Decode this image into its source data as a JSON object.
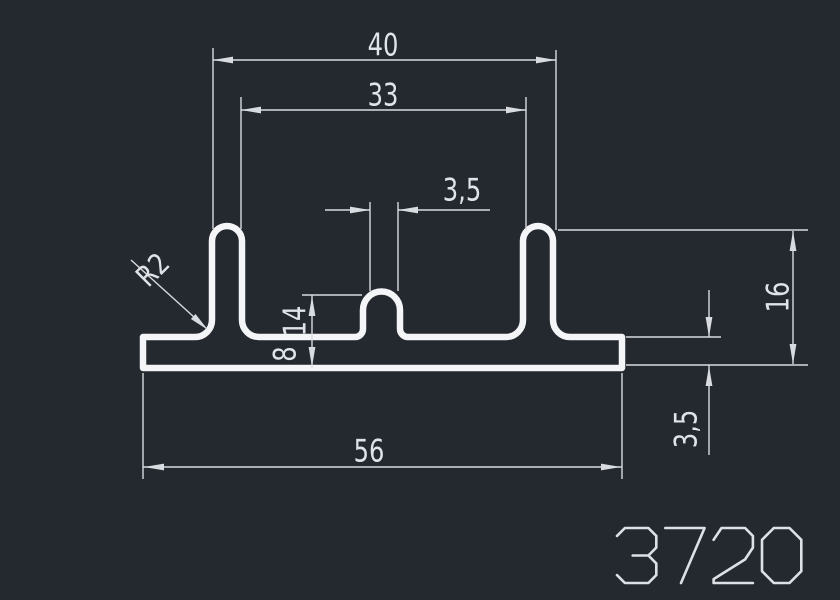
{
  "drawing": {
    "profile_number": "3720",
    "labels": {
      "width_fins_outer": "40",
      "width_fins_inner": "33",
      "bump_width": "3,5",
      "fillet_radius": "R2",
      "bump_height_upper": "14",
      "bump_height": "8",
      "width_overall": "56",
      "height_overall": "16",
      "base_thickness": "3,5"
    },
    "colors": {
      "background": "#242930",
      "dimension_lines": "#d8dce0",
      "profile_outline": "#f3f5f6",
      "text": "#e0e4e8"
    }
  }
}
